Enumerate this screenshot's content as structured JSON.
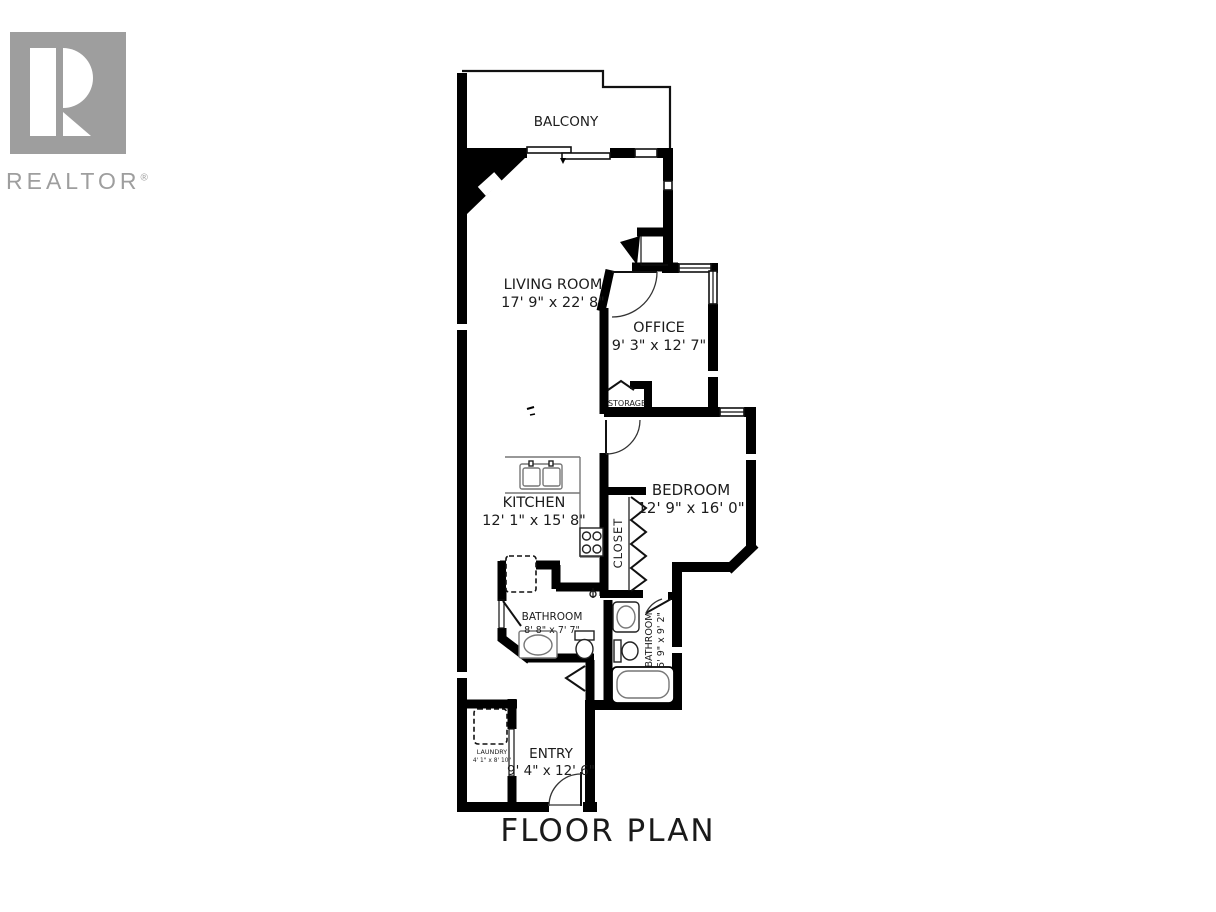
{
  "logo": {
    "brand": "REALTOR",
    "registered": "®"
  },
  "floor_plan": {
    "title": "FLOOR PLAN",
    "colors": {
      "wall": "#000000",
      "fixture_gray": "#8a8a8a",
      "logo_gray": "#9e9e9e",
      "text": "#1c1c1c",
      "background": "#ffffff"
    },
    "rooms": {
      "balcony": {
        "name": "BALCONY",
        "dims": ""
      },
      "living_room": {
        "name": "LIVING ROOM",
        "dims": "17' 9\" x 22' 8\""
      },
      "office": {
        "name": "OFFICE",
        "dims": "9' 3\" x 12' 7\""
      },
      "storage": {
        "name": "STORAGE",
        "dims": ""
      },
      "bedroom": {
        "name": "BEDROOM",
        "dims": "12' 9\" x 16' 0\""
      },
      "kitchen": {
        "name": "KITCHEN",
        "dims": "12' 1\" x 15' 8\""
      },
      "closet": {
        "name": "CLOSET",
        "dims": ""
      },
      "bathroom_main": {
        "name": "BATHROOM",
        "dims": "8' 8\" x 7' 7\""
      },
      "bathroom_ensuite": {
        "name": "BATHROOM",
        "dims": "5' 9\" x 9' 2\""
      },
      "laundry": {
        "name": "LAUNDRY",
        "dims": "4' 1\" x 8' 10\""
      },
      "entry": {
        "name": "ENTRY",
        "dims": "9' 4\" x 12' 6\""
      }
    }
  }
}
